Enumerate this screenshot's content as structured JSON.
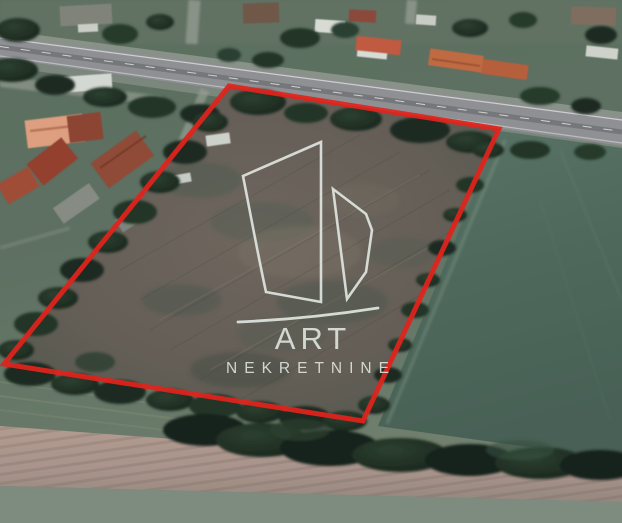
{
  "watermark": {
    "title": "ART",
    "subtitle": "NEKRETNINE",
    "color": "#e3e8e2"
  },
  "boundary": {
    "points": "229,86 499,129 363,421 4,364",
    "color": "#e0241c",
    "stroke_width": "5"
  },
  "palette": {
    "boundary_red": "#e0241c",
    "watermark_gray": "#e3e8e2",
    "field_green_right": "#4e695c",
    "plot_brown": "#69615a",
    "road_gray": "#909298",
    "tree_dark_green": "#1e2c21",
    "roof_orange": "#c06a43",
    "roof_salmon": "#dd9f80",
    "bottom_field_tan": "#b09a90",
    "bottom_strip_green": "#7e8b7f"
  }
}
